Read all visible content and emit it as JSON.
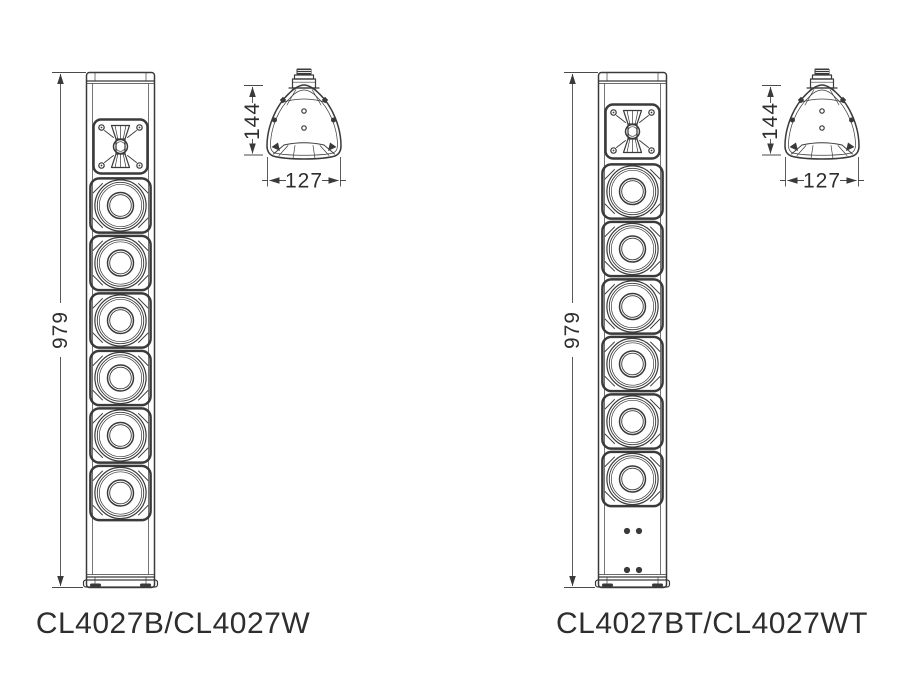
{
  "diagram": {
    "models": {
      "left": "CL4027B/CL4027W",
      "right": "CL4027BT/CL4027WT"
    },
    "dimensions": {
      "height_mm": "979",
      "depth_mm": "144",
      "width_mm": "127"
    },
    "structure": {
      "left_speaker": {
        "tweeters": 1,
        "woofers": 6
      },
      "right_speaker": {
        "tweeters": 1,
        "woofers": 6,
        "bottom_screw_pairs": 2
      }
    },
    "colors": {
      "line": "#3a3a3a",
      "text": "#2e2e2e",
      "background": "#ffffff"
    }
  }
}
